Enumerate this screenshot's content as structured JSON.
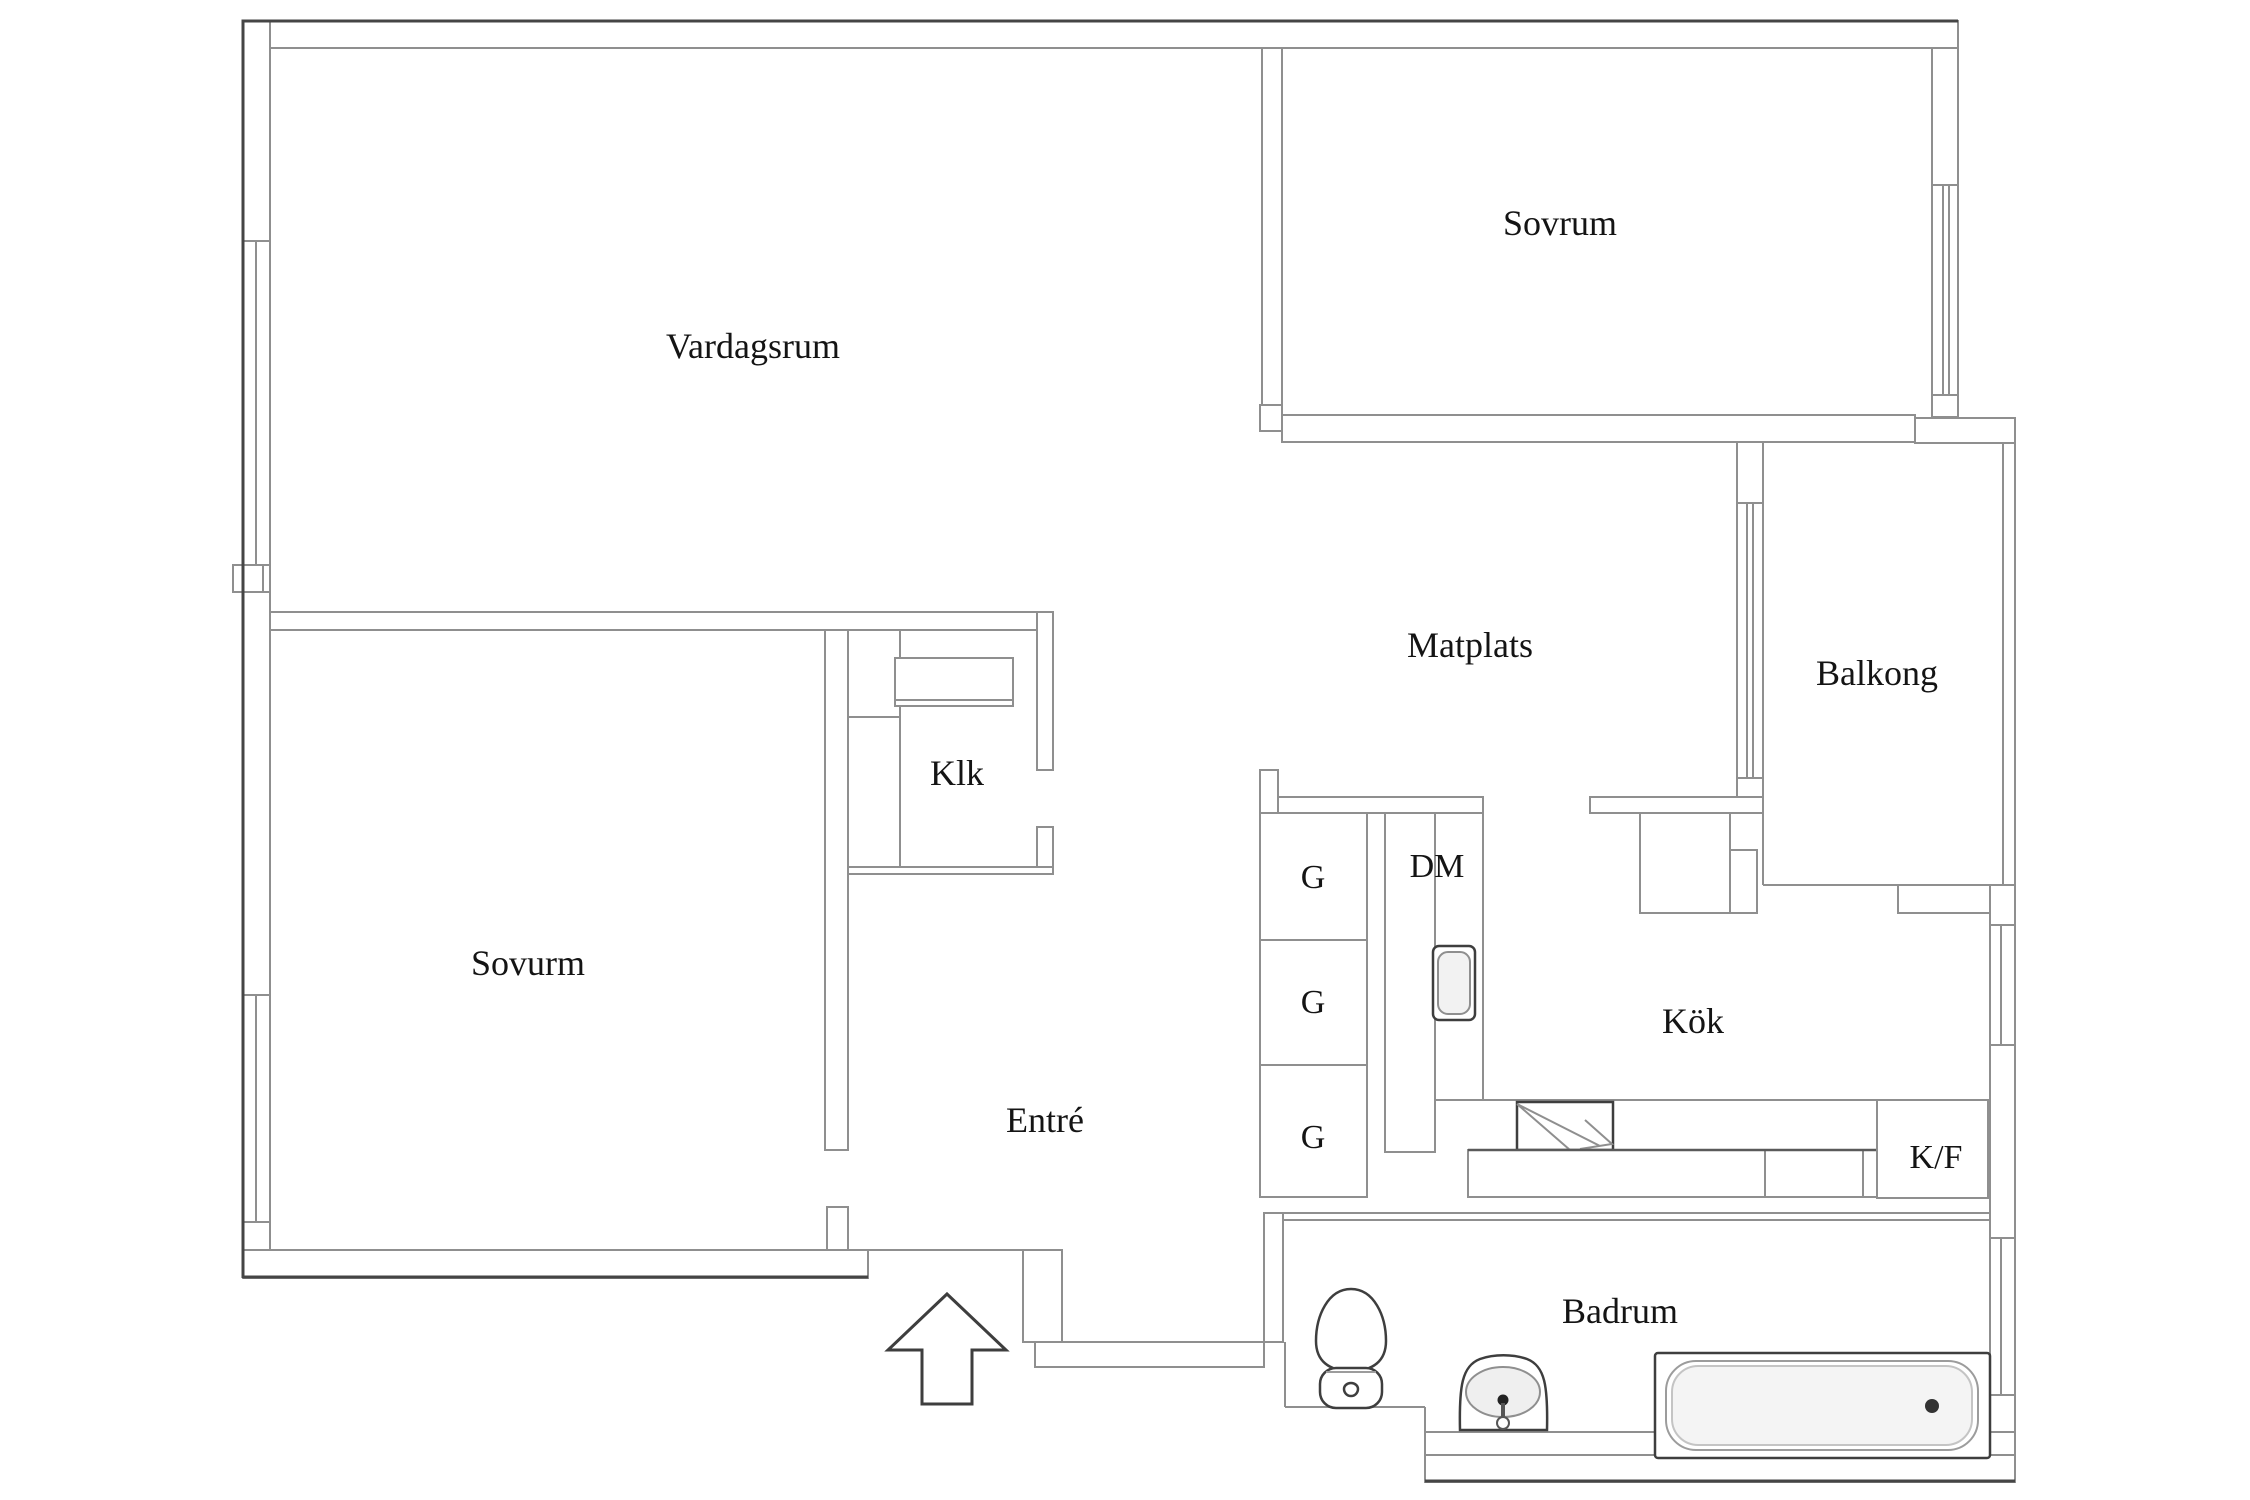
{
  "floorplan": {
    "title": "Apartment floor plan",
    "rooms": {
      "vardagsrum": {
        "label": "Vardagsrum"
      },
      "sovrum": {
        "label": "Sovrum"
      },
      "matplats": {
        "label": "Matplats"
      },
      "balkong": {
        "label": "Balkong"
      },
      "klk": {
        "label": "Klk"
      },
      "sovurm": {
        "label": "Sovurm"
      },
      "entre": {
        "label": "Entré"
      },
      "kok": {
        "label": "Kök"
      },
      "badrum": {
        "label": "Badrum"
      }
    },
    "appliances": {
      "g1": {
        "label": "G"
      },
      "g2": {
        "label": "G"
      },
      "g3": {
        "label": "G"
      },
      "dm": {
        "label": "DM"
      },
      "kf": {
        "label": "K/F"
      }
    },
    "icons": {
      "toilet": "toilet-icon",
      "sink": "sink-icon",
      "bathtub": "bathtub-icon",
      "kitchen_sink": "kitchen-sink-icon",
      "stove": "stove-icon",
      "entrance_arrow": "entrance-arrow-icon",
      "window": "window-icon"
    },
    "colors": {
      "wall_line": "#8f8f8f",
      "outline_dark": "#454545",
      "fixture_line": "#3e3e3e",
      "label_text": "#141414",
      "basin_fill": "#efefef",
      "background": "#ffffff"
    }
  }
}
